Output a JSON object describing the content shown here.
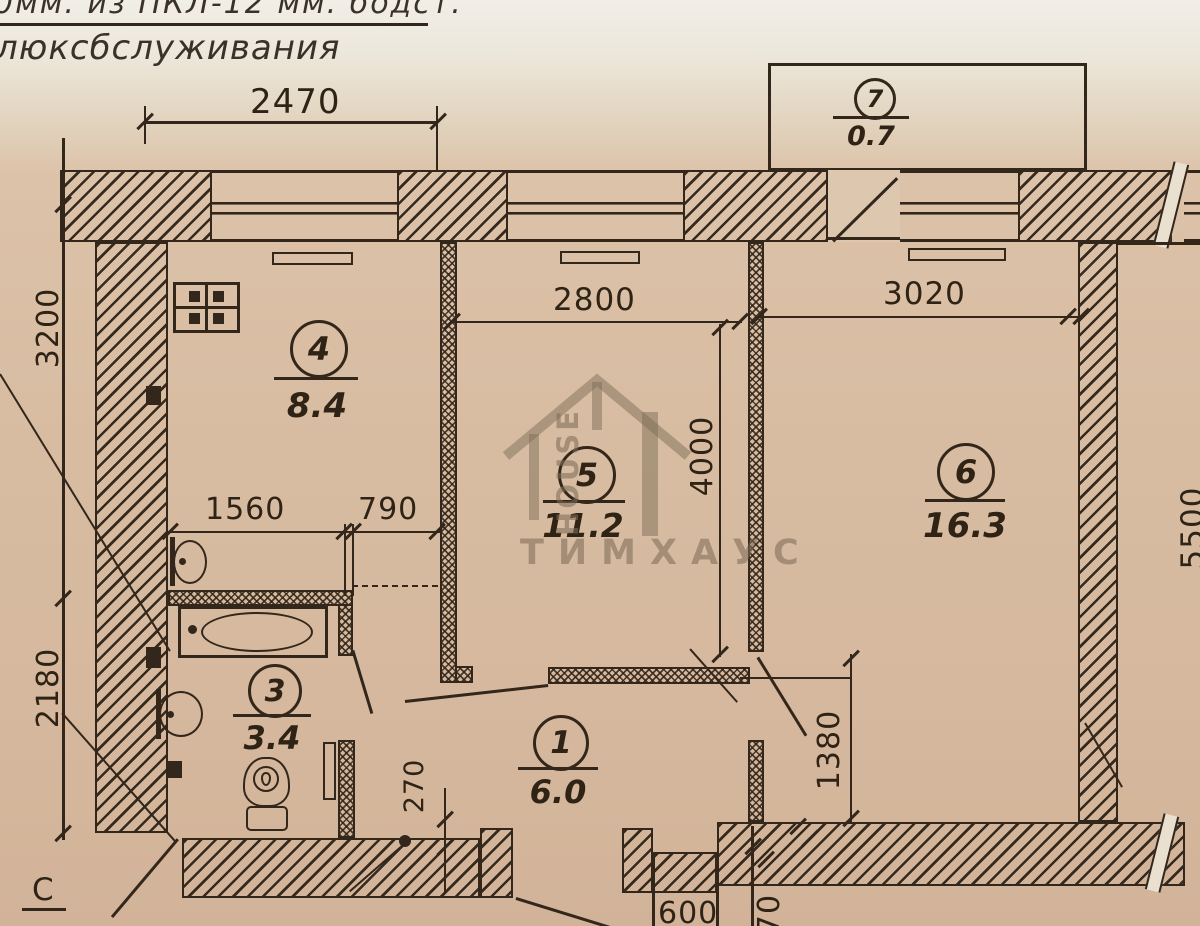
{
  "page": {
    "note_line1": "0мм.  из ПКЛ-12  мм.   бодст.",
    "note_line2": "люксбслуживания",
    "axis_label": "С",
    "watermark_brand": "ТИМХАУС",
    "watermark_word": "HOUSE"
  },
  "rooms": {
    "r1": {
      "num": "1",
      "area": "6.0"
    },
    "r3": {
      "num": "3",
      "area": "3.4"
    },
    "r4": {
      "num": "4",
      "area": "8.4"
    },
    "r5": {
      "num": "5",
      "area": "11.2"
    },
    "r6": {
      "num": "6",
      "area": "16.3"
    },
    "r7": {
      "num": "7",
      "area": "0.7"
    }
  },
  "dims": {
    "d2470": "2470",
    "d3200": "3200",
    "d2180": "2180",
    "d1560": "1560",
    "d790": "790",
    "d2800": "2800",
    "d3020": "3020",
    "d4000": "4000",
    "d5500": "5500",
    "d1380": "1380",
    "d270": "270",
    "d600": "600",
    "d70": "70"
  }
}
